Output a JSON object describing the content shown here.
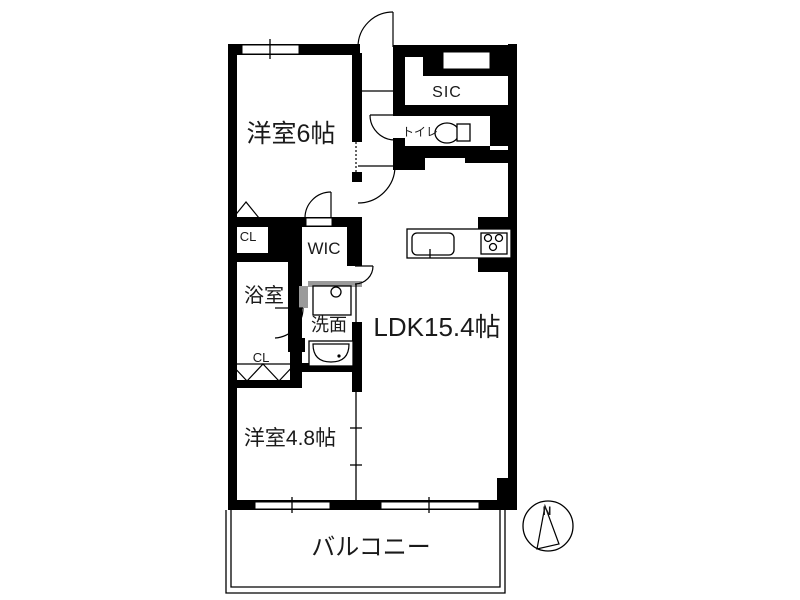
{
  "floorplan": {
    "title": "apartment-floor-plan",
    "rooms": [
      {
        "id": "western-room-6",
        "label": "洋室6帖"
      },
      {
        "id": "sic",
        "label": "SIC"
      },
      {
        "id": "toilet",
        "label": "トイレ"
      },
      {
        "id": "closet-upper",
        "label": "CL"
      },
      {
        "id": "wic",
        "label": "WIC"
      },
      {
        "id": "bathroom",
        "label": "浴室"
      },
      {
        "id": "washroom",
        "label": "洗面"
      },
      {
        "id": "ldk",
        "label": "LDK15.4帖"
      },
      {
        "id": "closet-lower",
        "label": "CL"
      },
      {
        "id": "western-room-4-8",
        "label": "洋室4.8帖"
      },
      {
        "id": "balcony",
        "label": "バルコニー"
      }
    ],
    "fixtures": [
      "toilet-bowl",
      "kitchen-counter",
      "kitchen-sink",
      "gas-stove",
      "washing-machine-pan",
      "vanity-basin",
      "bathtub-door",
      "folding-closet-doors"
    ],
    "compass": {
      "north_label": "N"
    },
    "colors": {
      "wall": "#000000",
      "background": "#ffffff",
      "sliding_door": "#9a9a9a"
    }
  }
}
